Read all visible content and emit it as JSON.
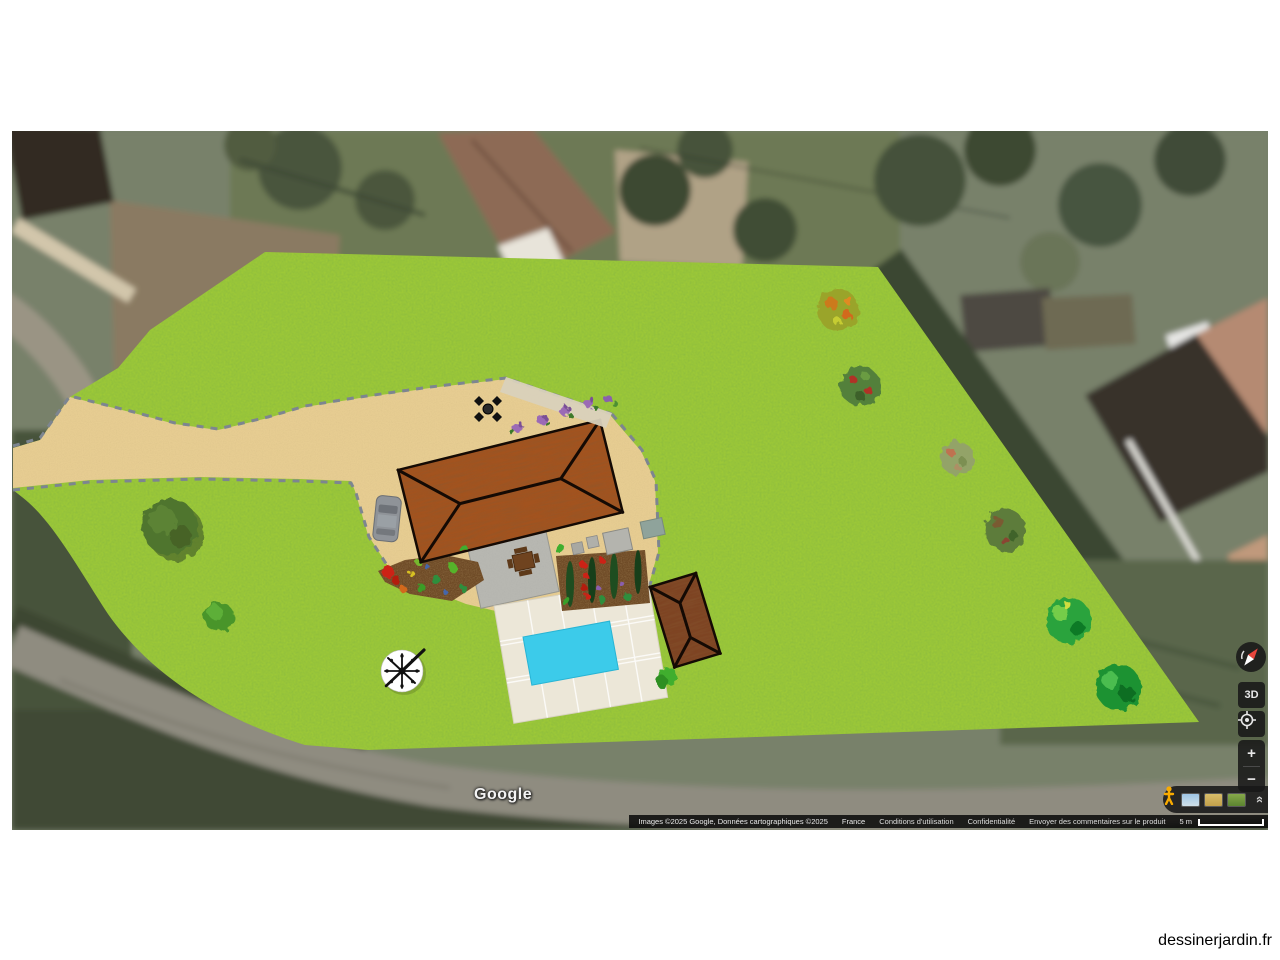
{
  "site": {
    "label": "dessinerjardin.fr"
  },
  "map": {
    "provider": "Google",
    "attribution": {
      "imagery": "Images ©2025 Google, Données cartographiques ©2025",
      "links": [
        "France",
        "Conditions d'utilisation",
        "Confidentialité",
        "Envoyer des commentaires sur le produit"
      ],
      "scale_label": "5 m"
    },
    "controls": {
      "tilt": "3D",
      "zoom_in": "+",
      "zoom_out": "−",
      "collapse": "»"
    }
  },
  "garden": {
    "colors": {
      "lawn": "#9cc838",
      "path": "#e7cd92",
      "roof_main": "#a2531f",
      "roof_outbuilding": "#7e4423",
      "pool": "#3ccbea",
      "terrace": "#ece7d8",
      "gravel": "#b7b7b1",
      "soil": "#6e4a26",
      "stone_edge": "#d9d1bc"
    }
  }
}
